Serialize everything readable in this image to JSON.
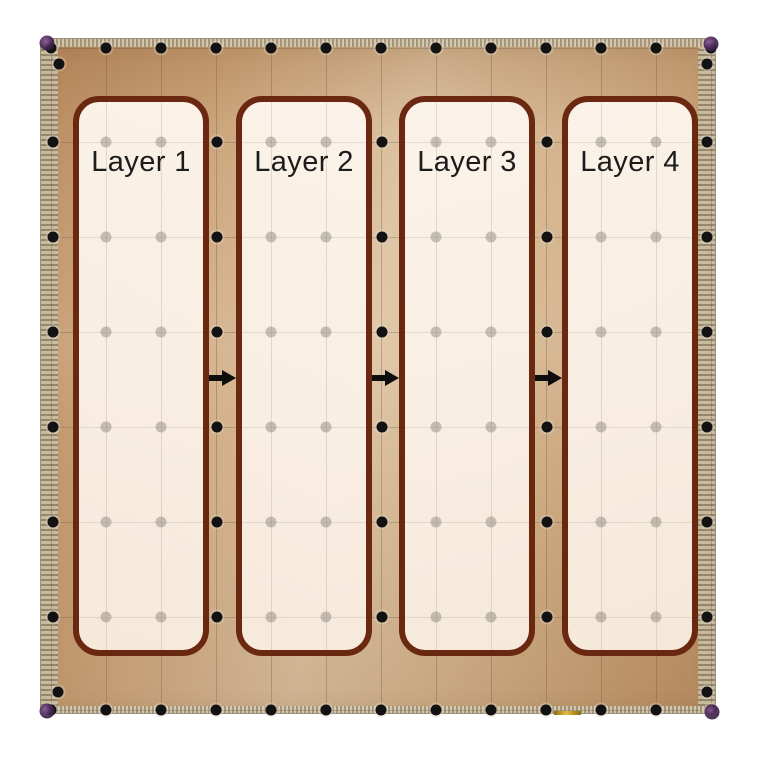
{
  "figure": {
    "kind": "annotated chip die photograph",
    "description": "Top-down die photo of a tan/bronze chip with a peripheral ring of black bond-pad dots, a faint interior dot grid, and four overlaid rounded rectangles labelled Layer 1 to Layer 4 connected left-to-right by black arrows."
  },
  "layers": [
    {
      "label": "Layer 1"
    },
    {
      "label": "Layer 2"
    },
    {
      "label": "Layer 3"
    },
    {
      "label": "Layer 4"
    }
  ],
  "arrows": [
    {
      "from": "Layer 1",
      "to": "Layer 2",
      "direction": "right"
    },
    {
      "from": "Layer 2",
      "to": "Layer 3",
      "direction": "right"
    },
    {
      "from": "Layer 3",
      "to": "Layer 4",
      "direction": "right"
    }
  ],
  "colors": {
    "page_bg": "#ffffff",
    "chip_tan_dark": "#ba8c61",
    "chip_tan_mid": "#d2b28b",
    "chip_tan_light": "#dcc2a1",
    "pad_band": "#b0a388",
    "box_border": "#6b2810",
    "box_fill": "#f9f0e5",
    "black_dot": "#121212",
    "gray_dot": "#8d857b",
    "grid_line": "#68563f",
    "corner_blob": "#4b2a57",
    "gold_mark": "#e3bc3f",
    "label_text": "#1c1c1c"
  },
  "layout": {
    "grid": {
      "columns_x": [
        10,
        65,
        120,
        175,
        230,
        285,
        340,
        395,
        450,
        505,
        560,
        615,
        670
      ],
      "rows_y": [
        103,
        198,
        293,
        388,
        483,
        578
      ],
      "pad_row_top_y": 9,
      "pad_row_bottom_y": 671,
      "pad_col_left_x": 12,
      "pad_col_right_x": 666,
      "gap_dot_cols_x": [
        176,
        341,
        506
      ],
      "gray_dot_cols_x": [
        65,
        120,
        230,
        285,
        395,
        450,
        560,
        615
      ],
      "extra_corner_dots": [
        [
          18,
          25
        ],
        [
          666,
          25
        ],
        [
          17,
          653
        ],
        [
          666,
          653
        ]
      ],
      "corner_blobs": [
        [
          6,
          4
        ],
        [
          670,
          5
        ],
        [
          6,
          672
        ],
        [
          671,
          673
        ]
      ]
    },
    "boxes": {
      "lefts": [
        32,
        195,
        358,
        521
      ],
      "top": 57,
      "width": 136,
      "height": 560
    },
    "arrow_centers_x": [
      181,
      344,
      507
    ],
    "arrow_center_y": 339
  }
}
